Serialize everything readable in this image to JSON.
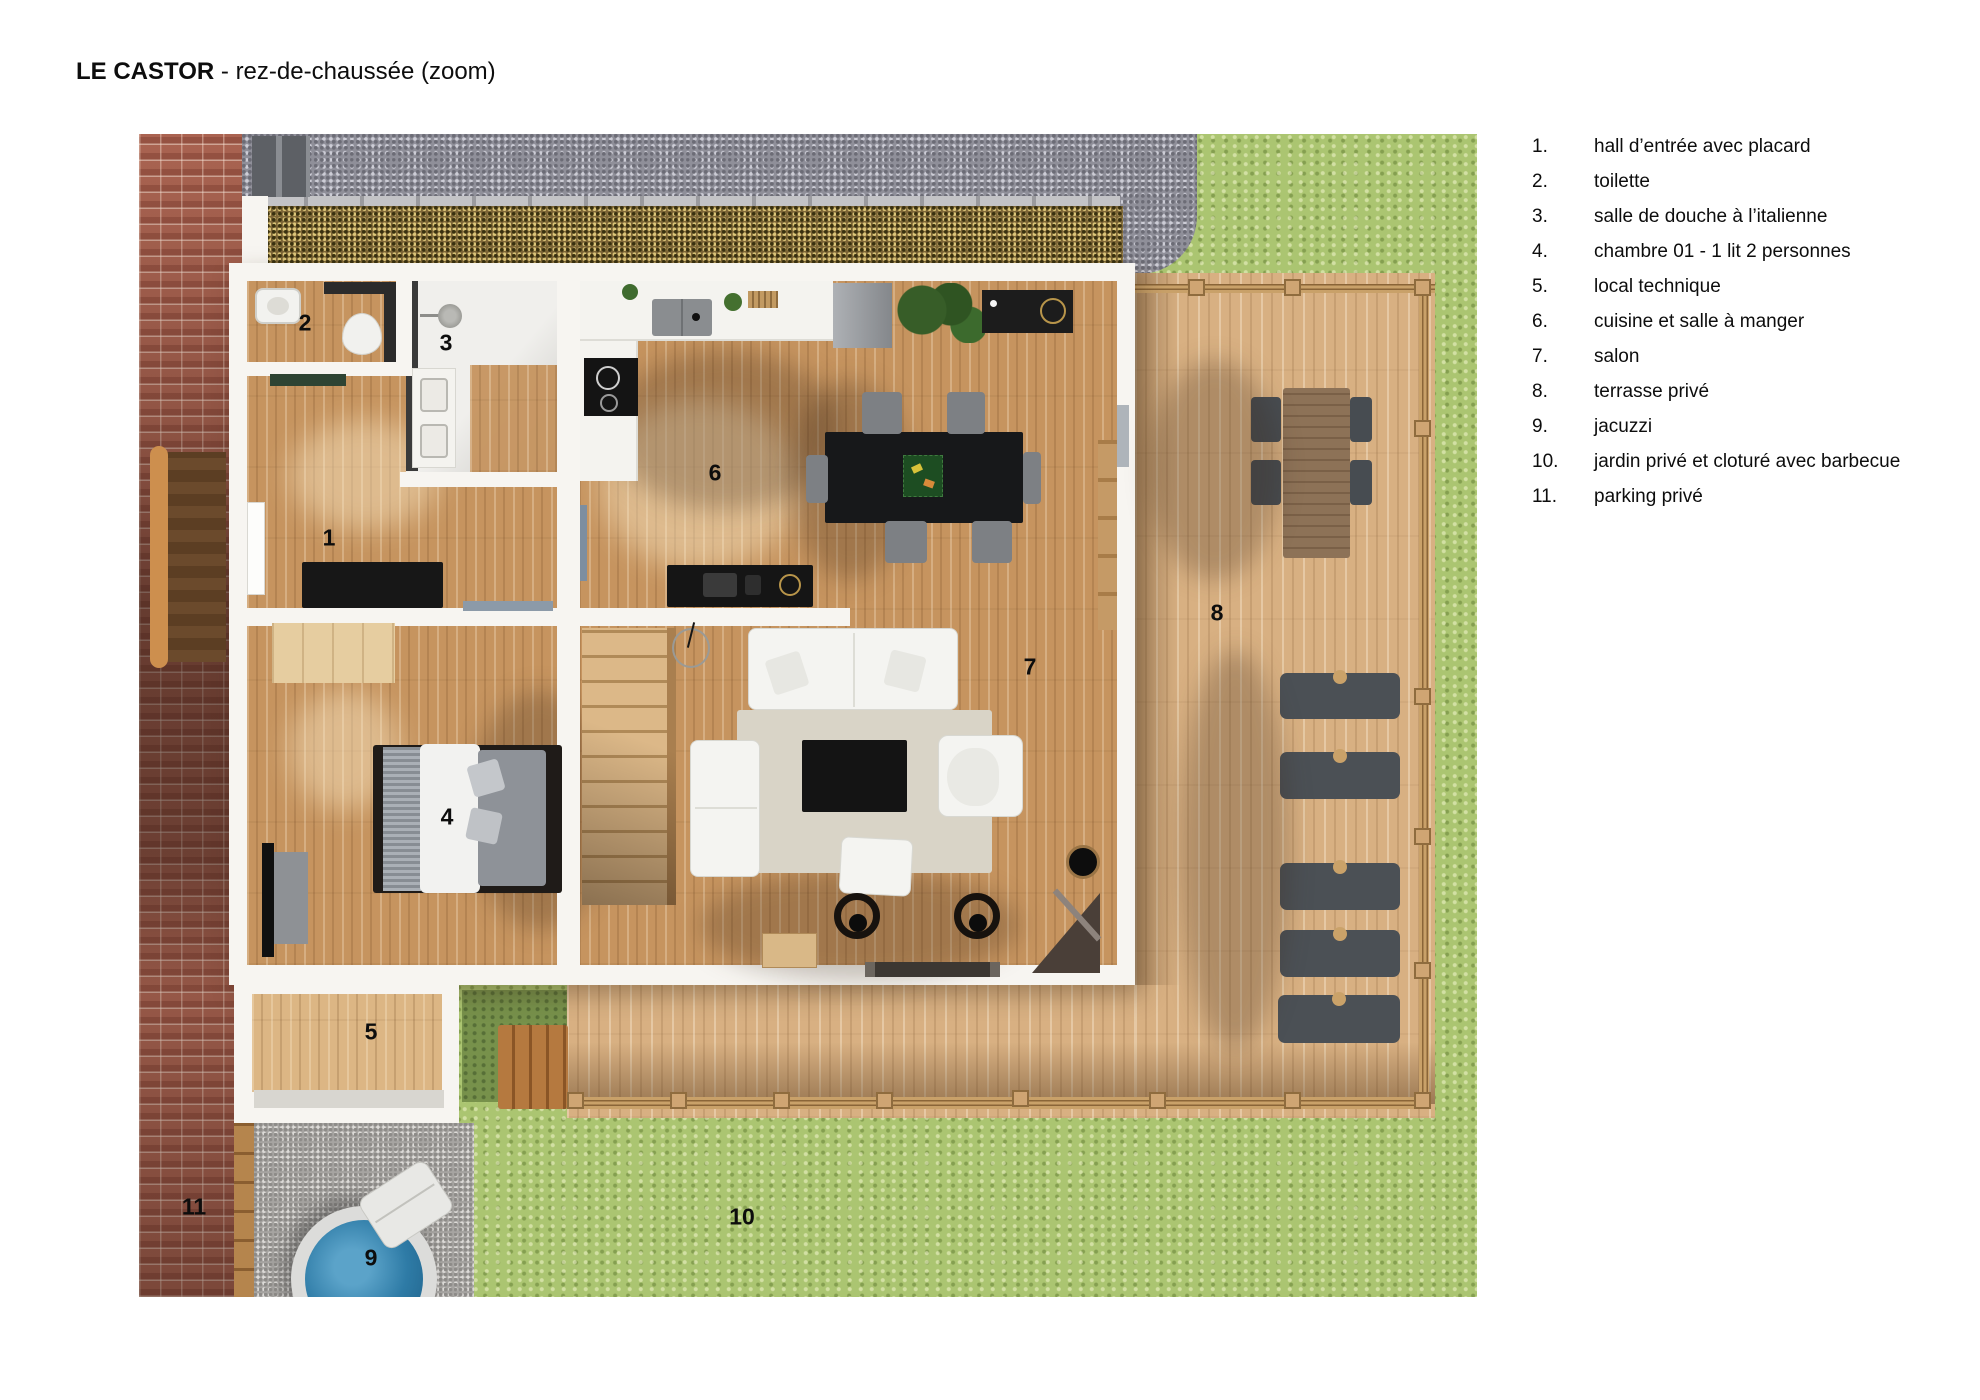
{
  "title": {
    "brand": "LE CASTOR",
    "rest": " - rez-de-chaussée (zoom)"
  },
  "legend": {
    "items": [
      {
        "num": "1.",
        "label": "hall d’entrée avec placard"
      },
      {
        "num": "2.",
        "label": "toilette"
      },
      {
        "num": "3.",
        "label": "salle de douche à l’italienne"
      },
      {
        "num": "4.",
        "label": "chambre 01 - 1 lit 2 personnes"
      },
      {
        "num": "5.",
        "label": "local technique"
      },
      {
        "num": "6.",
        "label": "cuisine et salle à manger"
      },
      {
        "num": "7.",
        "label": "salon"
      },
      {
        "num": "8.",
        "label": "terrasse privé"
      },
      {
        "num": "9.",
        "label": "jacuzzi"
      },
      {
        "num": "10.",
        "label": "jardin privé et cloturé avec barbecue"
      },
      {
        "num": "11.",
        "label": "parking privé"
      }
    ]
  },
  "plan": {
    "markers": [
      {
        "label": "1"
      },
      {
        "label": "2"
      },
      {
        "label": "3"
      },
      {
        "label": "4"
      },
      {
        "label": "5"
      },
      {
        "label": "6"
      },
      {
        "label": "7"
      },
      {
        "label": "8"
      },
      {
        "label": "9"
      },
      {
        "label": "10"
      },
      {
        "label": "11"
      }
    ]
  },
  "colors": {
    "text": "#0d0d0d",
    "wood_floor": "#c6945f",
    "deck_wood": "#d8b082",
    "grass": "#abc571",
    "grass_dark": "#77914b",
    "gravel": "#8f8f99",
    "gravel_brown": "#7d6637",
    "brick": "#a35f4e",
    "concrete": "#a6a4a1",
    "wall": "#f7f5f1",
    "water": "#2e7ba6",
    "furniture_dark": "#17181a"
  }
}
